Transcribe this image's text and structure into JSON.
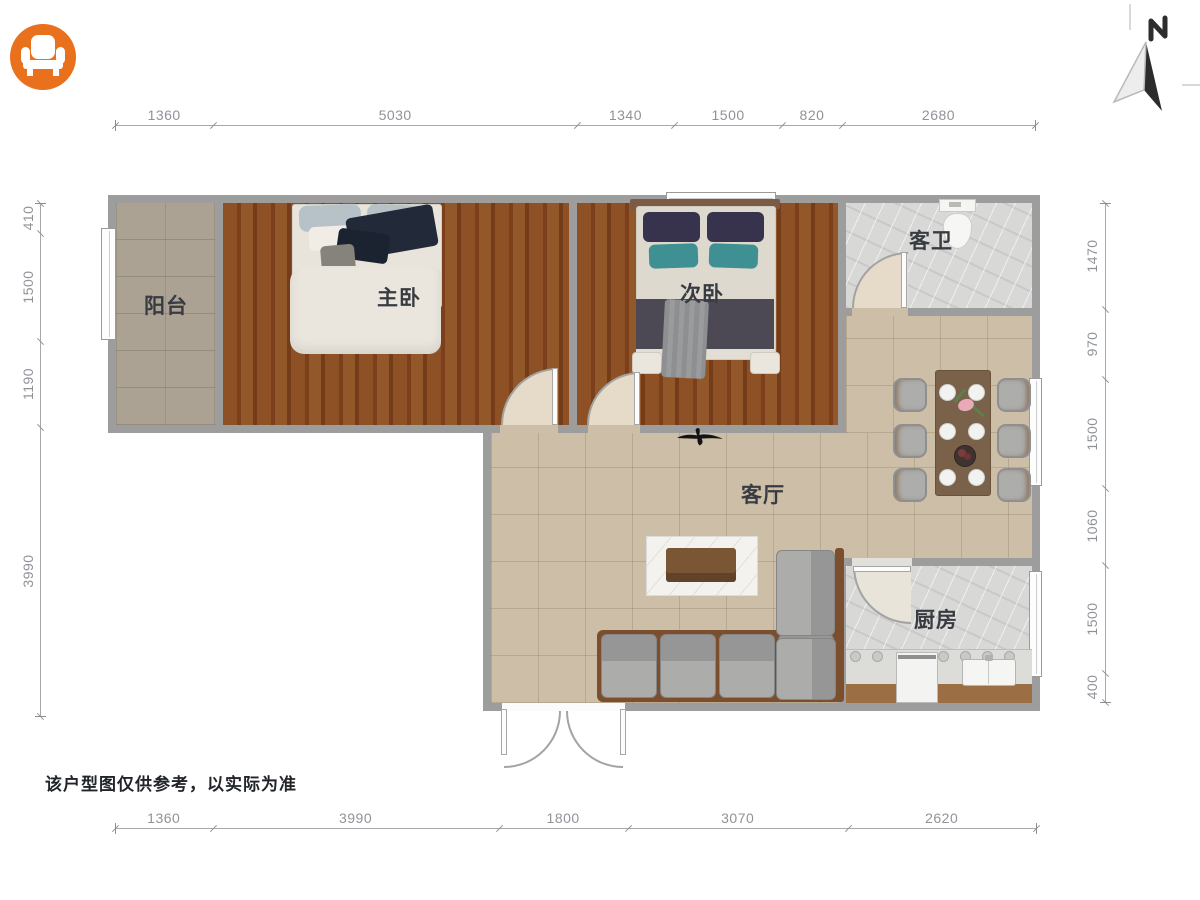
{
  "meta": {
    "disclaimer": "该户型图仅供参考，以实际为准",
    "north_label": "N"
  },
  "logo": {
    "icon": "armchair-icon",
    "background_color": "#E9701D"
  },
  "rooms": [
    {
      "id": "balcony",
      "label": "阳台"
    },
    {
      "id": "master-bedroom",
      "label": "主卧"
    },
    {
      "id": "second-bedroom",
      "label": "次卧"
    },
    {
      "id": "guest-bathroom",
      "label": "客卫"
    },
    {
      "id": "living-room",
      "label": "客厅"
    },
    {
      "id": "kitchen",
      "label": "厨房"
    }
  ],
  "dimensions_mm": {
    "top": [
      "1360",
      "5030",
      "1340",
      "1500",
      "820",
      "2680"
    ],
    "bottom": [
      "1360",
      "3990",
      "1800",
      "3070",
      "2620"
    ],
    "left": [
      "410",
      "1500",
      "1190",
      "3990"
    ],
    "right": [
      "1470",
      "970",
      "1500",
      "1060",
      "1500",
      "400"
    ]
  },
  "palette": {
    "wall": "#9D9D9D",
    "wood_floor": "#82471F",
    "living_floor": "#CDBFA7",
    "balcony_floor": "#ABA293",
    "marble_floor": "#D8D8D6",
    "logo_orange": "#E9701D",
    "dimension_text": "#8F9398",
    "label_text": "#383C42"
  }
}
